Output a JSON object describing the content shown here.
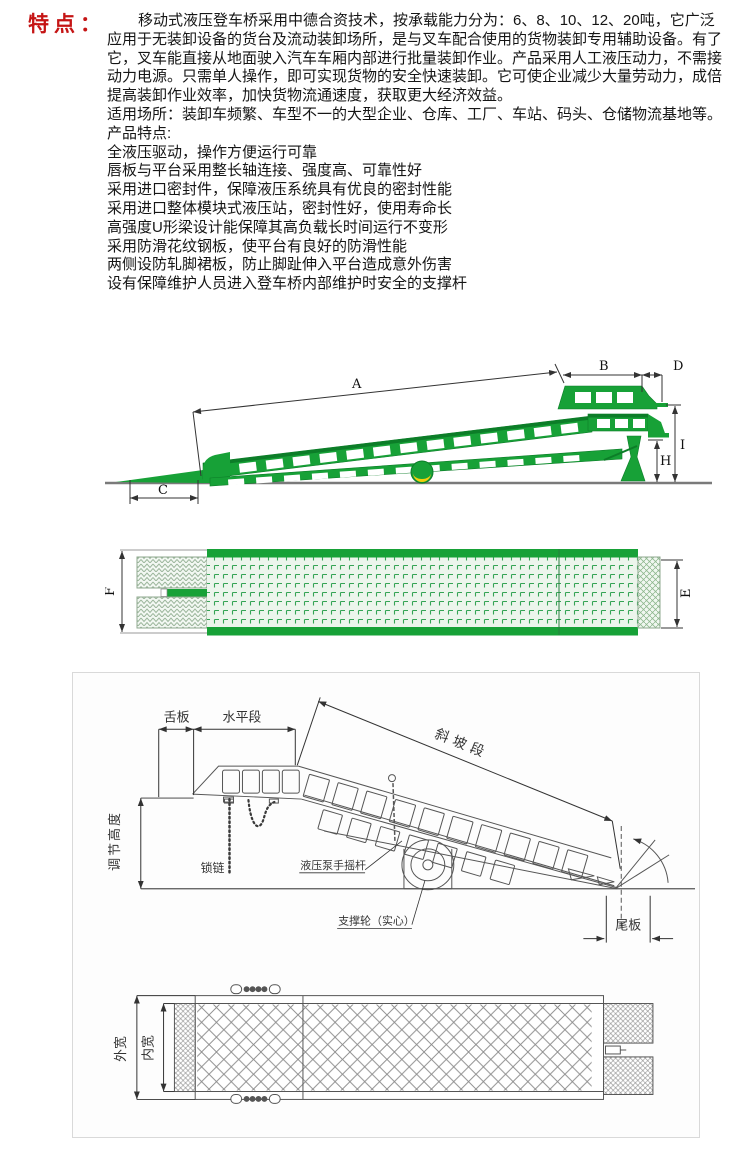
{
  "features": {
    "heading": "特点：",
    "lines": [
      "移动式液压登车桥采用中德合资技术，按承载能力分为：6、8、10、12、20吨，它广泛",
      "应用于无装卸设备的货台及流动装卸场所，是与叉车配合使用的货物装卸专用辅助设备。有了",
      "它，叉车能直接从地面驶入汽车车厢内部进行批量装卸作业。产品采用人工液压动力，不需接",
      "动力电源。只需单人操作，即可实现货物的安全快速装卸。它可使企业减少大量劳动力，成倍",
      "提高装卸作业效率，加快货物流通速度，获取更大经济效益。",
      "适用场所：装卸车频繁、车型不一的大型企业、仓库、工厂、车站、码头、仓储物流基地等。",
      "产品特点:",
      "全液压驱动，操作方便运行可靠",
      "唇板与平台采用整长轴连接、强度高、可靠性好",
      "采用进口密封件，保障液压系统具有优良的密封性能",
      "采用进口整体模块式液压站，密封性好，使用寿命长",
      "高强度U形梁设计能保障其高负载长时间运行不变形",
      "采用防滑花纹钢板，使平台有良好的防滑性能",
      "两侧设防轧脚裙板，防止脚趾伸入平台造成意外伤害",
      "设有保障维护人员进入登车桥内部维护时安全的支撑杆"
    ]
  },
  "colors": {
    "accent_red": "#c51414",
    "ramp_green": "#17a137",
    "ramp_green_dark": "#0c7d28",
    "wheel_yellow": "#f2cf0a",
    "drawing_line_gray": "#555555"
  },
  "diagram_ramp_side": {
    "dim_a": "A",
    "dim_b": "B",
    "dim_c": "C",
    "dim_d": "D",
    "dim_h": "H",
    "dim_i": "I"
  },
  "diagram_ramp_top": {
    "dim_e": "E",
    "dim_f": "F"
  },
  "diagram_line_side": {
    "tongue_plate": "舌板",
    "horizontal_section": "水平段",
    "slope_section": "斜坡段",
    "adjustable_height": "调节高度",
    "lock_chain": "锁链",
    "pump_lever": "液压泵手摇杆",
    "support_wheel": "支撑轮（实心）",
    "tail_plate": "尾板"
  },
  "diagram_line_top": {
    "outer_width": "外宽",
    "inner_width": "内宽"
  }
}
